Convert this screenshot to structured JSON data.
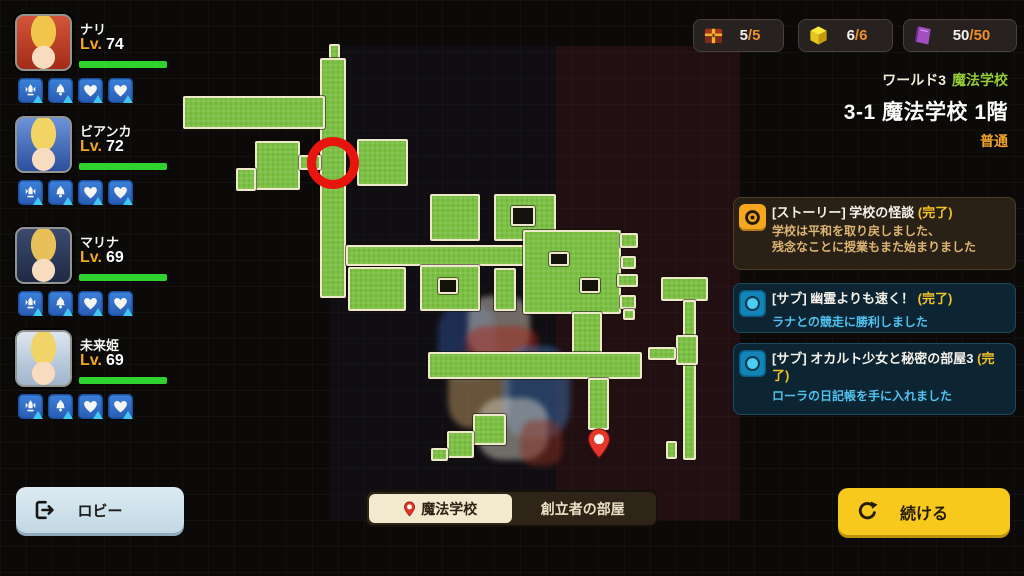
{
  "slash": "/",
  "party": {
    "lv_label": "Lv.",
    "members": [
      {
        "name": "ナリ",
        "level": "74",
        "hp_percent": 100,
        "art": {
          "bg": "#a32c18",
          "accent": "#d45438",
          "hair": "#f2c64a",
          "skin": "#f8dcc0"
        }
      },
      {
        "name": "ビアンカ",
        "level": "72",
        "hp_percent": 100,
        "art": {
          "bg": "#2c4f9e",
          "accent": "#6c93d8",
          "hair": "#f2d464",
          "skin": "#f8dcc0"
        }
      },
      {
        "name": "マリナ",
        "level": "69",
        "hp_percent": 100,
        "art": {
          "bg": "#1f2a44",
          "accent": "#3c4a6e",
          "hair": "#e8c05a",
          "skin": "#f8dcc0"
        }
      },
      {
        "name": "未来姫",
        "level": "69",
        "hp_percent": 100,
        "art": {
          "bg": "#9fb4cc",
          "accent": "#dde6ef",
          "hair": "#f0d468",
          "skin": "#f8dcc0"
        }
      }
    ],
    "skill_icons": [
      "crest",
      "bell",
      "heart",
      "heart"
    ]
  },
  "resources": [
    {
      "icon": "treasure-chest",
      "current": "5",
      "max": "5"
    },
    {
      "icon": "gold-cube",
      "current": "6",
      "max": "6"
    },
    {
      "icon": "purple-book",
      "current": "50",
      "max": "50"
    }
  ],
  "stage_info": {
    "world_label": "ワールド3",
    "world_name": "魔法学校",
    "stage_title": "3-1 魔法学校 1階",
    "difficulty": "普通"
  },
  "quests": [
    {
      "kind": "story",
      "title": "[ストーリー] 学校の怪談",
      "status": "(完了)",
      "desc_lines": [
        "学校は平和を取り戻しました、",
        "残念なことに授業もまた始まりました"
      ]
    },
    {
      "kind": "sub",
      "title": "[サブ] 幽霊よりも速く！",
      "status": "(完了)",
      "desc_lines": [
        "ラナとの競走に勝利しました"
      ]
    },
    {
      "kind": "sub",
      "title": "[サブ] オカルト少女と秘密の部屋3",
      "status": "(完了)",
      "desc_lines": [
        "ローラの日記帳を手に入れました"
      ]
    }
  ],
  "footer": {
    "lobby_label": "ロビー",
    "tabs": [
      {
        "label": "魔法学校",
        "active": true
      },
      {
        "label": "創立者の部屋",
        "active": false
      }
    ],
    "continue_label": "続ける"
  },
  "colors": {
    "map_green": "#7cc143",
    "map_outline": "#efe8cb",
    "marker_red": "#e8150e",
    "accent_orange": "#f5a81e",
    "status_yellow": "#f2c225",
    "sub_cyan": "#4fc2ef",
    "story_tan": "#dcb473",
    "hp_green": "#2fd22f"
  },
  "map": {
    "marker_circle": {
      "x": 333,
      "y": 163
    },
    "pin": {
      "x": 599,
      "y": 442
    },
    "rooms": [
      [
        329,
        44,
        11,
        18
      ],
      [
        320,
        58,
        26,
        240
      ],
      [
        183,
        96,
        142,
        33
      ],
      [
        255,
        141,
        45,
        49
      ],
      [
        236,
        168,
        20,
        23
      ],
      [
        299,
        155,
        22,
        15
      ],
      [
        357,
        139,
        51,
        47
      ],
      [
        346,
        245,
        214,
        21
      ],
      [
        348,
        267,
        58,
        44
      ],
      [
        430,
        194,
        50,
        47
      ],
      [
        494,
        194,
        62,
        47
      ],
      [
        511,
        206,
        24,
        20,
        "hole"
      ],
      [
        420,
        265,
        60,
        46
      ],
      [
        438,
        278,
        20,
        16,
        "hole"
      ],
      [
        494,
        268,
        22,
        43
      ],
      [
        523,
        230,
        98,
        84
      ],
      [
        549,
        252,
        20,
        14,
        "hole"
      ],
      [
        580,
        278,
        20,
        15,
        "hole"
      ],
      [
        572,
        312,
        30,
        44
      ],
      [
        620,
        233,
        18,
        15
      ],
      [
        621,
        256,
        15,
        13
      ],
      [
        617,
        274,
        21,
        13
      ],
      [
        620,
        295,
        16,
        14
      ],
      [
        623,
        309,
        12,
        11
      ],
      [
        661,
        277,
        47,
        24
      ],
      [
        683,
        300,
        13,
        160
      ],
      [
        676,
        335,
        22,
        30
      ],
      [
        648,
        347,
        28,
        13
      ],
      [
        666,
        441,
        11,
        18
      ],
      [
        428,
        352,
        214,
        27
      ],
      [
        588,
        378,
        21,
        52
      ],
      [
        473,
        414,
        33,
        31
      ],
      [
        447,
        431,
        27,
        27
      ],
      [
        431,
        448,
        17,
        13
      ]
    ],
    "sprites": [
      [
        438,
        305,
        58,
        75,
        "#2c4f92"
      ],
      [
        468,
        296,
        62,
        62,
        "#cdc6b6"
      ],
      [
        466,
        326,
        72,
        38,
        "#a82818"
      ],
      [
        448,
        356,
        62,
        72,
        "#c09a62"
      ],
      [
        502,
        346,
        68,
        92,
        "#3f6fae"
      ],
      [
        478,
        398,
        70,
        62,
        "#d0ccbe"
      ],
      [
        520,
        420,
        42,
        46,
        "#8c3020"
      ]
    ]
  }
}
